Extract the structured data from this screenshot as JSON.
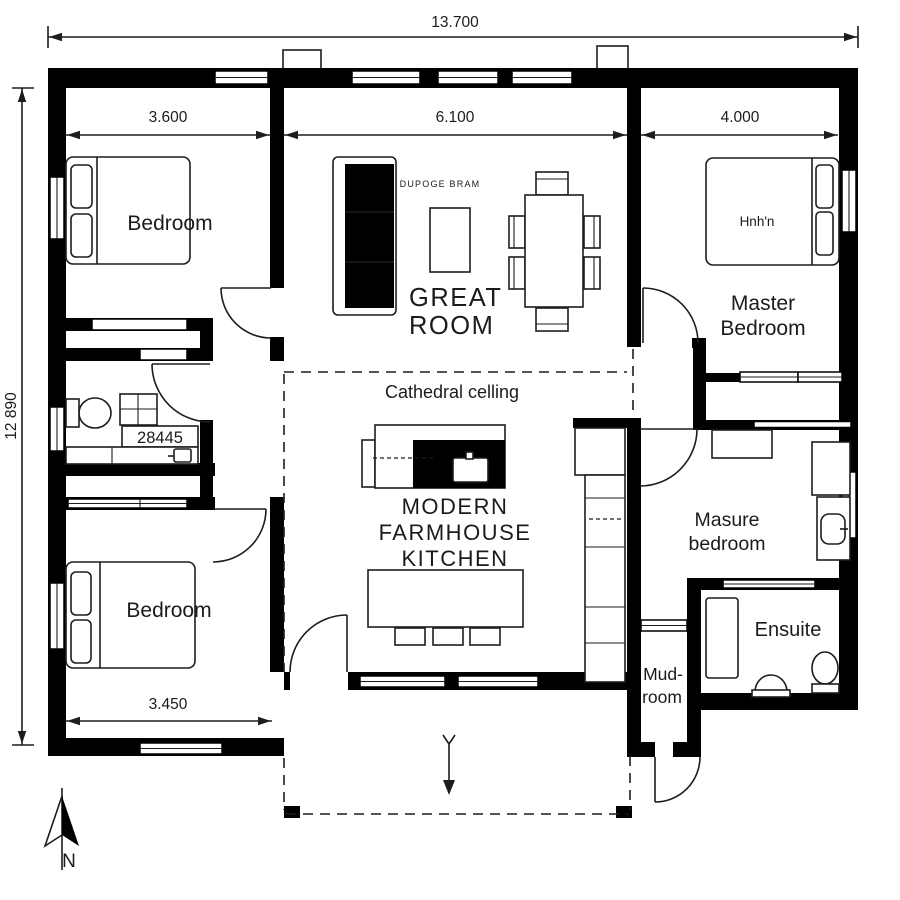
{
  "plan": {
    "dimensions": {
      "overall_width": "13.700",
      "overall_depth": "12 890",
      "bedroom_top_width": "3.600",
      "great_room_width": "6.100",
      "master_width": "4.000",
      "bedroom_bottom_width": "3.450"
    },
    "rooms": {
      "bedroom_top": "Bedroom",
      "bedroom_bottom": "Bedroom",
      "great_line1": "GREAT",
      "great_line2": "ROOM",
      "master_line1": "Master",
      "master_line2": "Bedroom",
      "kitchen_line1": "MODERN",
      "kitchen_line2": "FARMHOUSE",
      "kitchen_line3": "KITCHEN",
      "masure_line1": "Masure",
      "masure_line2": "bedroom",
      "ensuite": "Ensuite",
      "mud_line1": "Mud-",
      "mud_line2": "room",
      "cathedral": "Cathedral celling"
    },
    "annotations": {
      "sofa_brand": "DUPOGE BRAM",
      "master_bed_text": "Hnh'n",
      "bath_code": "28445",
      "north": "N"
    },
    "colors": {
      "wall": "#000000",
      "background": "#ffffff",
      "line": "#1d1d1d"
    }
  }
}
